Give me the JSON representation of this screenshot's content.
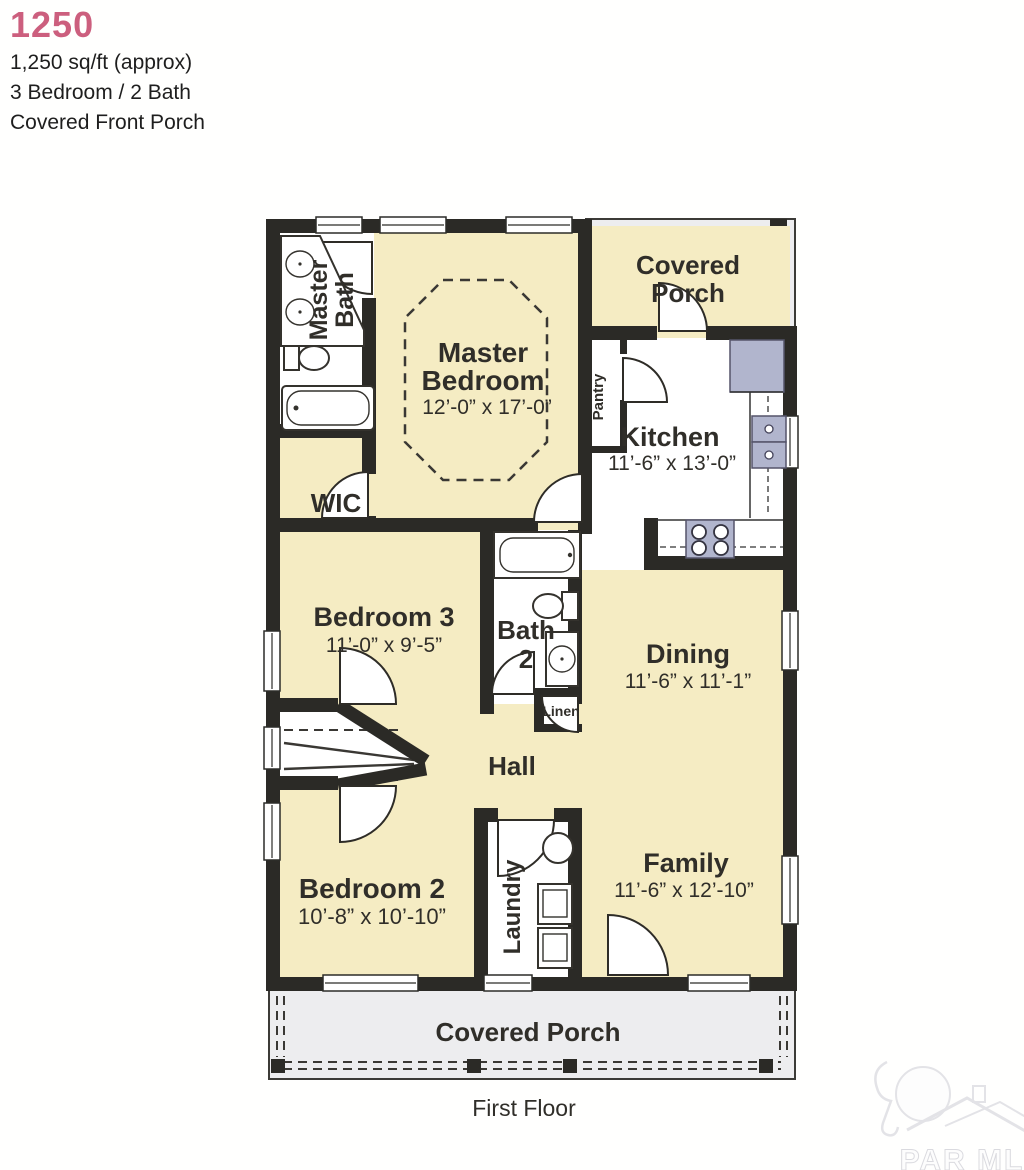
{
  "header": {
    "plan_number": "1250",
    "line1": "1,250 sq/ft (approx)",
    "line2": "3 Bedroom / 2 Bath",
    "line3": "Covered Front Porch"
  },
  "rooms": {
    "master_bath": {
      "line1": "Master",
      "line2": "Bath"
    },
    "master_bedroom": {
      "line1": "Master",
      "line2": "Bedroom",
      "dims": "12’-0” x 17’-0”"
    },
    "wic": {
      "name": "WIC"
    },
    "covered_porch_rear": {
      "line1": "Covered",
      "line2": "Porch"
    },
    "pantry": {
      "name": "Pantry"
    },
    "kitchen": {
      "name": "Kitchen",
      "dims": "11’-6” x 13’-0”"
    },
    "bedroom3": {
      "name": "Bedroom 3",
      "dims": "11’-0” x 9’-5”"
    },
    "bath2": {
      "line1": "Bath",
      "line2": "2"
    },
    "linen": {
      "name": "Linen"
    },
    "dining": {
      "name": "Dining",
      "dims": "11’-6” x 11’-1”"
    },
    "hall": {
      "name": "Hall"
    },
    "bedroom2": {
      "name": "Bedroom 2",
      "dims": "10’-8” x 10’-10”"
    },
    "laundry": {
      "name": "Laundry"
    },
    "family": {
      "name": "Family",
      "dims": "11’-6” x 12’-10”"
    },
    "covered_porch_front": {
      "name": "Covered Porch"
    }
  },
  "footer": {
    "floor_label": "First Floor"
  },
  "watermark": {
    "text": "PAR MLS"
  },
  "colors": {
    "accent": "#cc5f7e",
    "wall": "#2b2a26",
    "room_fill": "#f5ecc3",
    "porch_fill": "#ededef",
    "appliance": "#b1b5cd",
    "fixture_line": "#34322d",
    "label_text": "#302e29"
  }
}
